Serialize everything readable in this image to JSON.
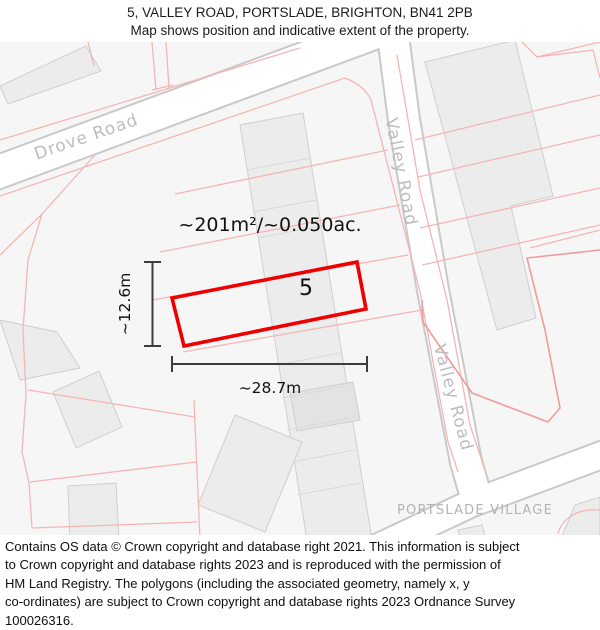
{
  "header": {
    "title": "5, VALLEY ROAD, PORTSLADE, BRIGHTON, BN41 2PB",
    "subtitle": "Map shows position and indicative extent of the property."
  },
  "map": {
    "labels": {
      "plot_number": "5",
      "area": "~201m²/~0.050ac.",
      "width": "~28.7m",
      "depth": "~12.6m",
      "district": "PORTSLADE VILLAGE",
      "road_drove": "Drove Road",
      "road_valley_upper": "Valley Road",
      "road_valley_lower": "Valley Road"
    },
    "colors": {
      "plot_outline": "#ee0000",
      "parcel_line": "#f5b5b5",
      "parcel_line_strong": "#f09b9b",
      "building_fill": "#ececec",
      "building_stroke": "#cfcfcf",
      "road_fill": "#ffffff",
      "road_casing": "#c9c9c9",
      "map_background": "#f7f6f6",
      "road_label": "#bdbdbd",
      "dimension_line": "#3d3d3d"
    }
  },
  "footer": {
    "attribution_lines": [
      "Contains OS data © Crown copyright and database right 2021. This information is subject",
      "to Crown copyright and database rights 2023 and is reproduced with the permission of",
      "HM Land Registry. The polygons (including the associated geometry, namely x, y",
      "co-ordinates) are subject to Crown copyright and database rights 2023 Ordnance Survey",
      "100026316."
    ]
  }
}
